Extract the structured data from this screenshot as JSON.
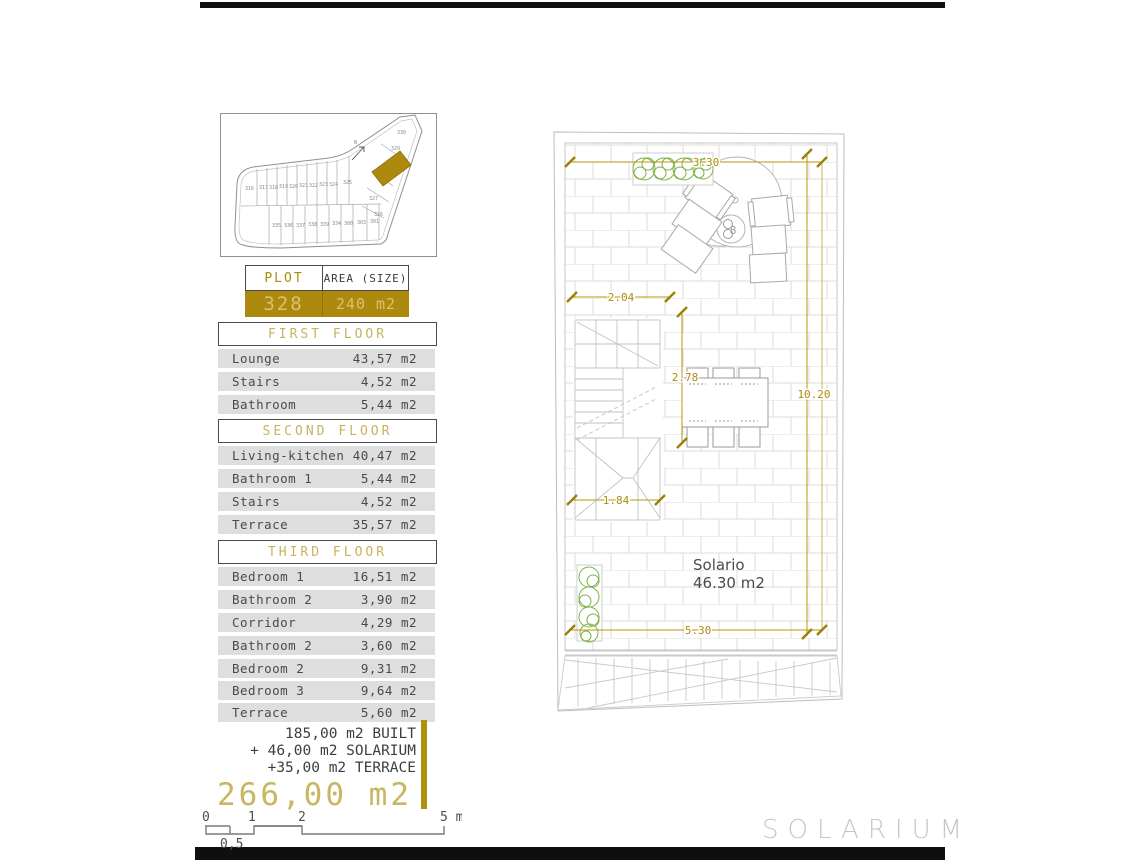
{
  "page": {
    "footer_label": "SOLARIUM",
    "accent_gold": "#ad8a0e",
    "dim_gold": "#ab8c0f",
    "plant_green": "#7db249"
  },
  "site_map": {
    "north_label": "N",
    "highlighted_plot": "328",
    "plots_middle_row": [
      "316",
      "317",
      "318",
      "319",
      "320",
      "321",
      "322",
      "323",
      "324",
      "325"
    ],
    "plots_bottom_row": [
      "335",
      "336",
      "337",
      "338",
      "339",
      "334",
      "300",
      "303",
      "301"
    ],
    "plots_right_column": [
      "330",
      "329",
      "327",
      "326"
    ]
  },
  "plot_table": {
    "col1_header": "PLOT",
    "col2_header": "AREA (SIZE)",
    "plot_number": "328",
    "area": "240 m2"
  },
  "floors": [
    {
      "title": "FIRST FLOOR",
      "rows": [
        [
          "Lounge",
          "43,57 m2"
        ],
        [
          "Stairs",
          "4,52 m2"
        ],
        [
          "Bathroom",
          "5,44 m2"
        ]
      ]
    },
    {
      "title": "SECOND FLOOR",
      "rows": [
        [
          "Living-kitchen",
          "40,47 m2"
        ],
        [
          "Bathroom 1",
          "5,44 m2"
        ],
        [
          "Stairs",
          "4,52 m2"
        ],
        [
          "Terrace",
          "35,57 m2"
        ]
      ]
    },
    {
      "title": "THIRD FLOOR",
      "rows": [
        [
          "Bedroom 1",
          "16,51 m2"
        ],
        [
          "Bathroom 2",
          "3,90 m2"
        ],
        [
          "Corridor",
          "4,29 m2"
        ],
        [
          "Bathroom 2",
          "3,60 m2"
        ],
        [
          "Bedroom 2",
          "9,31 m2"
        ],
        [
          "Bedroom 3",
          "9,64 m2"
        ],
        [
          "Terrace",
          "5,60 m2"
        ]
      ]
    }
  ],
  "summary": {
    "line1": "185,00 m2 BUILT",
    "line2": "+ 46,00 m2 SOLARIUM",
    "line3": "+35,00 m2 TERRACE",
    "total": "266,00 m2"
  },
  "scale_bar": {
    "tick0": "0",
    "tick1": "1",
    "tick2": "2",
    "end_label": "5 m",
    "sub_label": "0,5"
  },
  "plan": {
    "room_name": "Solario",
    "room_area": "46.30 m2",
    "spa_label": "8",
    "dim_top": "3.30",
    "dim_upper_left": "2.04",
    "dim_center_vertical": "2.78",
    "dim_right_vertical": "10.20",
    "dim_lower_left": "1.84",
    "dim_bottom": "5.30"
  }
}
